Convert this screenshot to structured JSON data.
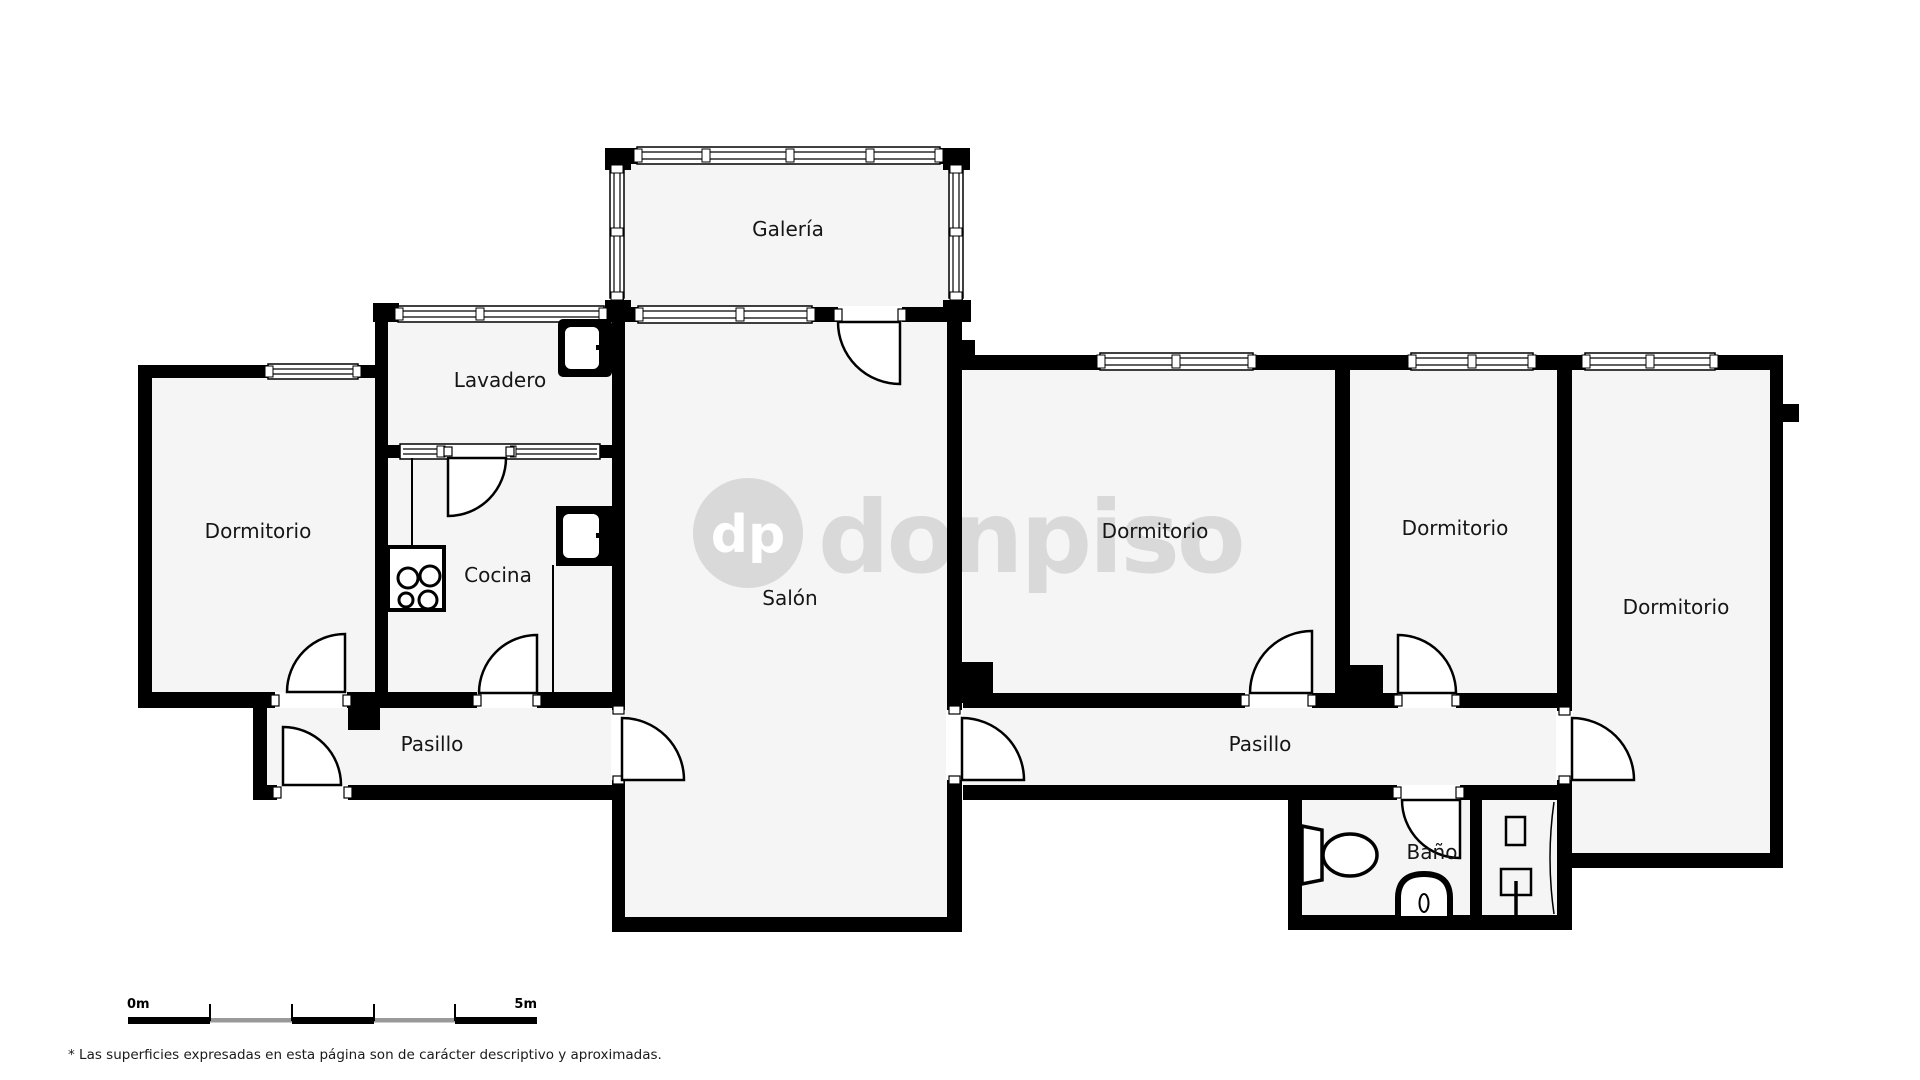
{
  "watermark": {
    "initials": "dp",
    "brand": "donpiso",
    "color": "#d9d9d9",
    "initials_color": "#ffffff"
  },
  "rooms": {
    "galeria": {
      "label": "Galería"
    },
    "lavadero": {
      "label": "Lavadero"
    },
    "dormitorio1": {
      "label": "Dormitorio"
    },
    "cocina": {
      "label": "Cocina"
    },
    "salon": {
      "label": "Salón"
    },
    "dormitorio2": {
      "label": "Dormitorio"
    },
    "dormitorio3": {
      "label": "Dormitorio"
    },
    "dormitorio4": {
      "label": "Dormitorio"
    },
    "pasillo1": {
      "label": "Pasillo"
    },
    "pasillo2": {
      "label": "Pasillo"
    },
    "bano": {
      "label": "Baño"
    }
  },
  "icons": {
    "stove": "stove-4-burners-icon",
    "kitchen_sink": "sink-icon",
    "laundry_sink": "sink-icon",
    "toilet": "toilet-icon",
    "bidet": "bidet-icon",
    "washbasin": "washbasin-icon"
  },
  "colors": {
    "wall": "#000000",
    "floor": "#f5f5f5",
    "scale_gray": "#999999"
  },
  "scale_bar": {
    "start_label": "0m",
    "end_label": "5m",
    "segment_colors": [
      "#000000",
      "#999999",
      "#000000",
      "#999999",
      "#000000"
    ]
  },
  "footnote": "* Las superficies expresadas en esta página son de carácter descriptivo y aproximadas."
}
